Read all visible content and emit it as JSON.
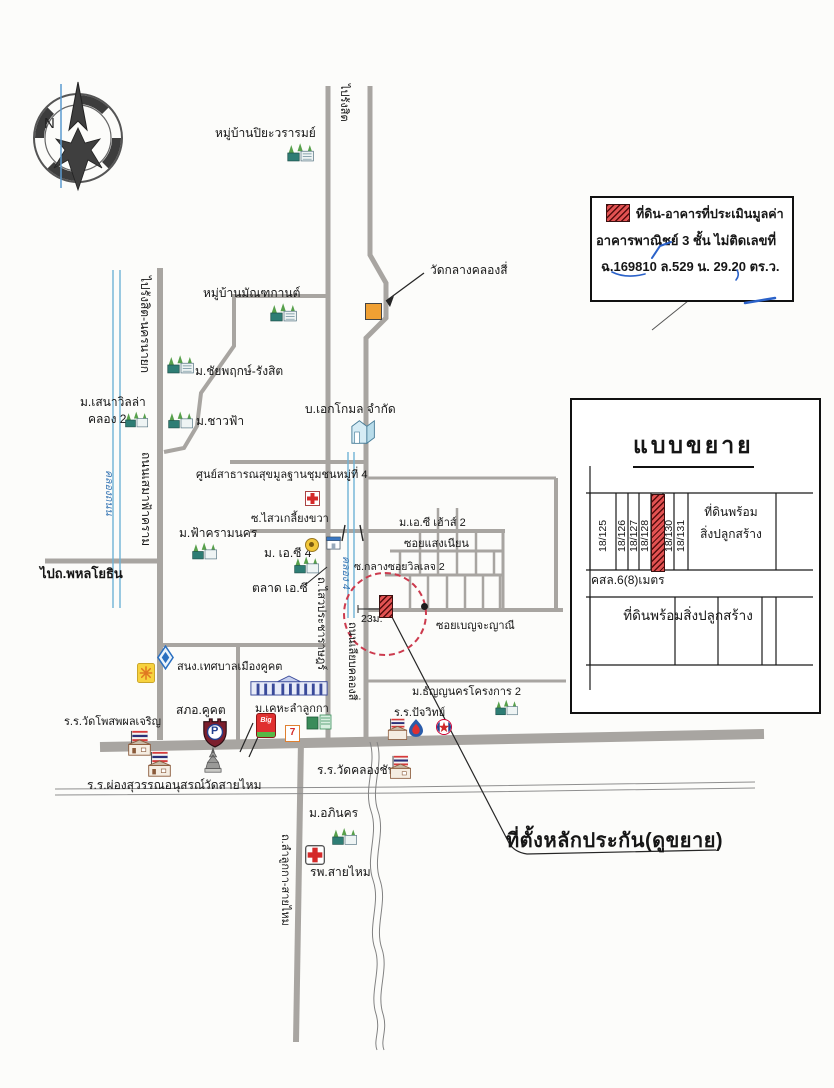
{
  "compass": {
    "north": "N"
  },
  "legend": {
    "line1": "ที่ดิน-อาคารที่ประเมินมูลค่า",
    "line2": "อาคารพาณิชย์ 3 ชั้น  ไม่ติดเลขที่",
    "line3": "ฉ.169810  ล.529  น. 29.20 ตร.ว."
  },
  "inset": {
    "title": "แบบขยาย",
    "lots": [
      "18/125",
      "18/126",
      "18/127",
      "18/128",
      "18/130",
      "18/131"
    ],
    "wide_lot_line1": "ที่ดินพร้อม",
    "wide_lot_line2": "สิ่งปลูกสร้าง",
    "road": "คสล.6(8)เมตร",
    "bottom_lot": "ที่ดินพร้อมสิ่งปลูกสร้าง"
  },
  "callout": {
    "site": "ที่ตั้งหลักประกัน(ดูขยาย)",
    "width": "23ม."
  },
  "labels": {
    "piyawararom": "หมู่บ้านปิยะวรารมย์",
    "to_rangsit": "ไปรังสิต",
    "wat_klang": "วัดกลางคลองสี่",
    "mantakan": "หมู่บ้านมัณฑกานต์",
    "chaiyapruek": "ม.ชัยพฤกษ์-รังสิต",
    "senavilla1": "ม.เสนาวิลล่า",
    "senavilla2": "คลอง 2",
    "chaofa": "ม.ชาวฟ้า",
    "ekkomon": "บ.เอกโกมล จำกัด",
    "to_rangsit_nakhonnayok": "ไปรังสิต-นครนายก",
    "semafakram": "ถนนเสมาฟ้าคราม",
    "khlong_thanon": "คลองถนน",
    "health_center": "ศูนย์สาธารณสุขมูลฐานชุมชนหมู่ที่ 4",
    "sawai_kliang_khwa": "ซ.ไสวเกลี้ยงขวา",
    "fakram_nakhon": "ม.ฟ้าครามนคร",
    "ac4": "ม. เอ.ซี 4",
    "talad_ac": "ตลาด เอ.ซี",
    "ac_house2": "ม.เอ.ซี เฮ้าส์ 2",
    "soi_saeng_nian": "ซอยแสงเนียน",
    "soi_klang_village2": "ซ.กลางซอยวิลเลจ 2",
    "soi_benjayani": "ซอยเบญจะญาณี",
    "to_phahonyothin": "ไปถ.พหลโยธิน",
    "municipality": "สนง.เทศบาลเมืองคูคต",
    "police": "สภอ.คูคต",
    "khela_lamlukka": "ม.เคหะลำลูกกา",
    "sawai_pracharat": "ถ.ไสวประชาราษฎร์",
    "liap_khlong_si": "ถนนเลียบคลองสี่",
    "khlong4": "คลอง 4",
    "thanyanakhon": "ม.ธัญญนครโครงการ 2",
    "pajawit": "ร.ร.ปัจวิทย์",
    "phosop": "ร.ร.วัดโพสพผลเจริญ",
    "phongsuwan": "ร.ร.ผ่องสุวรรณอนุสรณ์",
    "wat_saimai": "วัดสายไหม",
    "wat_khlongchan": "ร.ร.วัดคลองชัน",
    "apinakhon": "ม.อภินคร",
    "saimai_hospital": "รพ.สายไหม",
    "lamlukka_saimai": "ถ.ลำลูกกา-สายไหม"
  },
  "icons": {
    "police_letter": "P",
    "bigc_text": "Big",
    "seven_text": "7"
  },
  "colors": {
    "road": "#a8a5a1",
    "canal": "#6fb3d6",
    "subject_red": "#e25252",
    "circle_red": "#cc3b4e",
    "pen_blue": "#2b62c9"
  }
}
